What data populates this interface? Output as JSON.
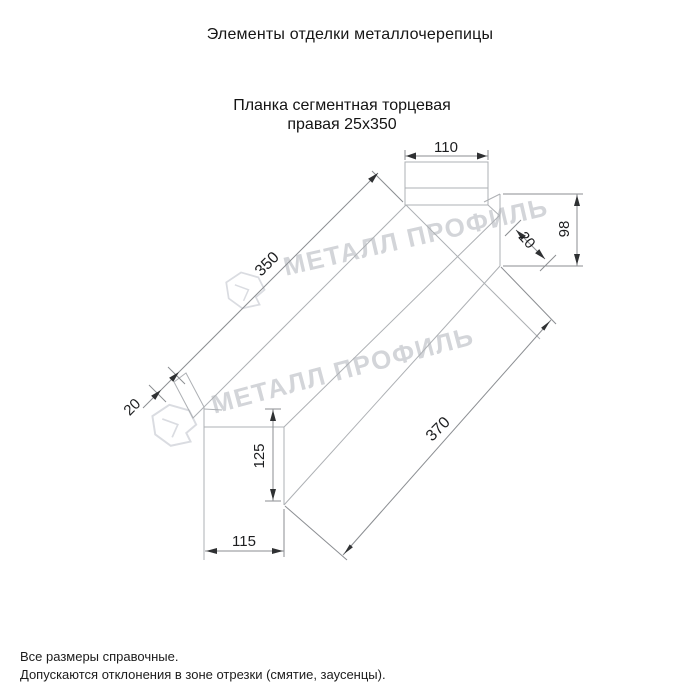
{
  "page": {
    "title": "Элементы отделки металлочерепицы"
  },
  "product": {
    "name_line1": "Планка сегментная торцевая",
    "name_line2": "правая 25х350"
  },
  "drawing": {
    "dimensions": {
      "top_flange_width": "110",
      "upper_length": "350",
      "lower_length": "370",
      "end_drop_height": "98",
      "front_height": "125",
      "front_width": "115",
      "left_lip": "20",
      "right_lip": "20"
    }
  },
  "watermark": {
    "text": "МЕТАЛЛ ПРОФИЛЬ"
  },
  "footer": {
    "note1": "Все размеры справочные.",
    "note2": "Допускаются отклонения в зоне отрезки (смятие, заусенцы)."
  },
  "colors": {
    "background": "#ffffff",
    "geometry_line": "#adb0b4",
    "dimension_line": "#8b8e92",
    "dimension_text": "#1d1e20",
    "title_text": "#161616",
    "watermark": "#d3d5d9"
  }
}
